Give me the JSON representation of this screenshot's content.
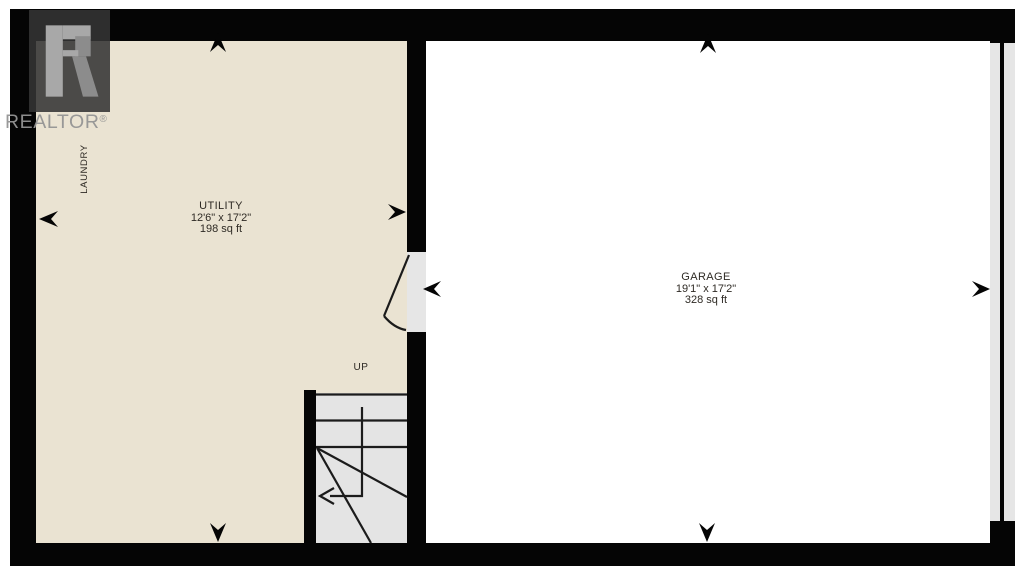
{
  "watermark": {
    "logo_letter": "R",
    "brand": "REALTOR",
    "registered_mark": "®"
  },
  "rooms": [
    {
      "name": "UTILITY",
      "dimensions": "12'6\" x 17'2\"",
      "area": "198 sq ft"
    },
    {
      "name": "GARAGE",
      "dimensions": "19'1\" x 17'2\"",
      "area": "328 sq ft"
    }
  ],
  "annotations": {
    "laundry": "LAUNDRY",
    "stairs_direction": "UP"
  },
  "icons": [
    "direction-arrow-up-utility",
    "direction-arrow-left-utility",
    "direction-arrow-right-utility",
    "direction-arrow-down-utility",
    "direction-arrow-up-garage",
    "direction-arrow-left-garage-door",
    "direction-arrow-right-garage",
    "direction-arrow-down-garage",
    "stairs-up-arrow",
    "door-swing-arc",
    "garage-overhead-door"
  ],
  "colors": {
    "wall": "#050505",
    "room_fill": "#EAE3D2",
    "garage_fill": "#FFFFFF",
    "stair_fill": "#E4E4E4",
    "door_fill": "#E6E6E6",
    "line": "#1B1B1B",
    "label_text": "#2E2A24",
    "watermark_gray": "#919191"
  }
}
